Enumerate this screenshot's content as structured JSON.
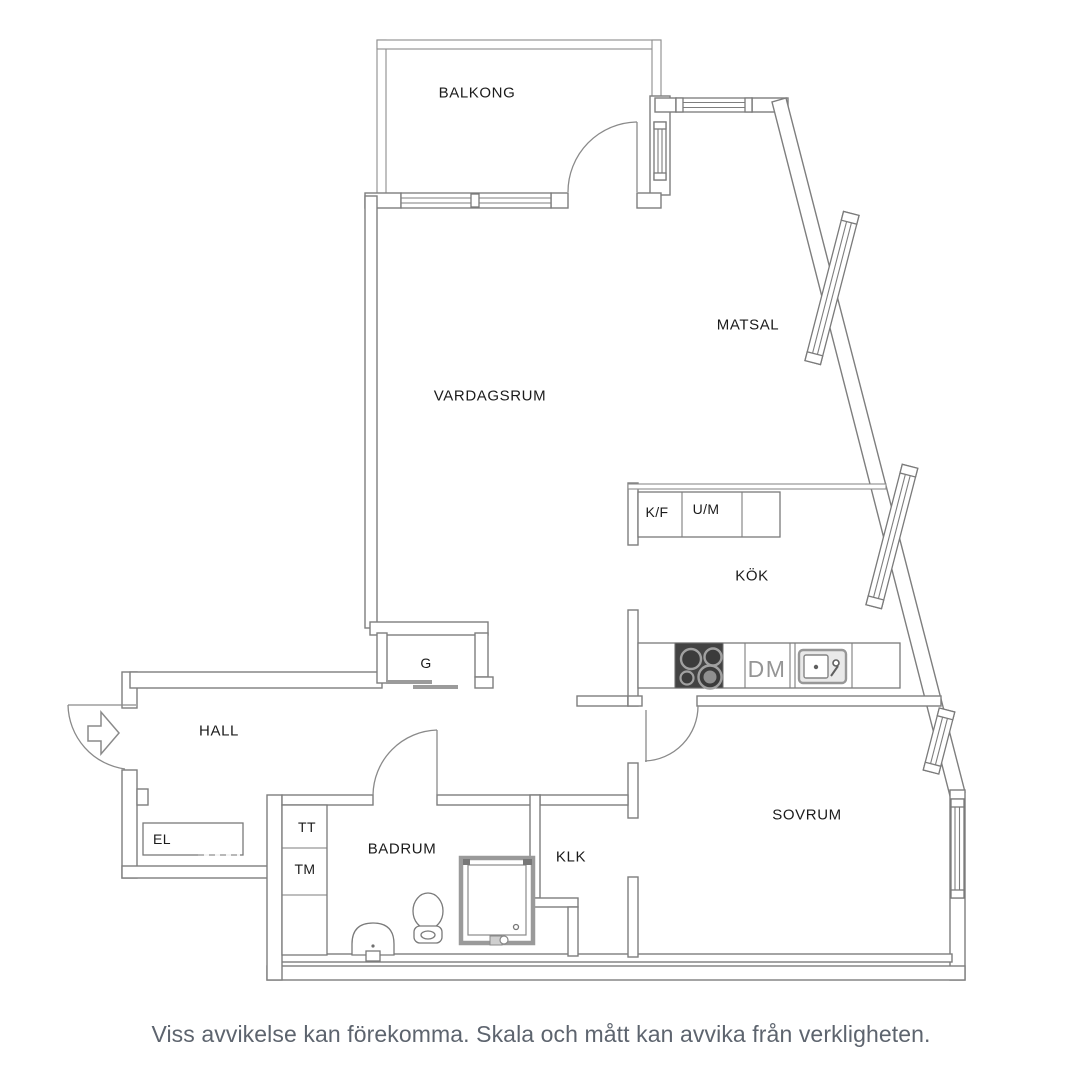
{
  "floorplan": {
    "title_type": "apartment-floor-plan",
    "labels": {
      "balkong": "BALKONG",
      "matsal": "MATSAL",
      "vardagsrum": "VARDAGSRUM",
      "kok": "KÖK",
      "hall": "HALL",
      "badrum": "BADRUM",
      "klk": "KLK",
      "sovrum": "SOVRUM",
      "g": "G",
      "el": "EL",
      "tt": "TT",
      "tm": "TM",
      "kf": "K/F",
      "um": "U/M",
      "dm": "DM"
    },
    "disclaimer": "Viss avvikelse kan förekomma. Skala och mått kan avvika från verkligheten.",
    "colors": {
      "background": "#ffffff",
      "wall_line": "#7e7e7e",
      "label_text": "#1b1b1b",
      "dm_text": "#959595",
      "stove_dark": "#434343",
      "slider_gray": "#9b9b9b",
      "disclaimer_text": "#5d646e"
    }
  }
}
